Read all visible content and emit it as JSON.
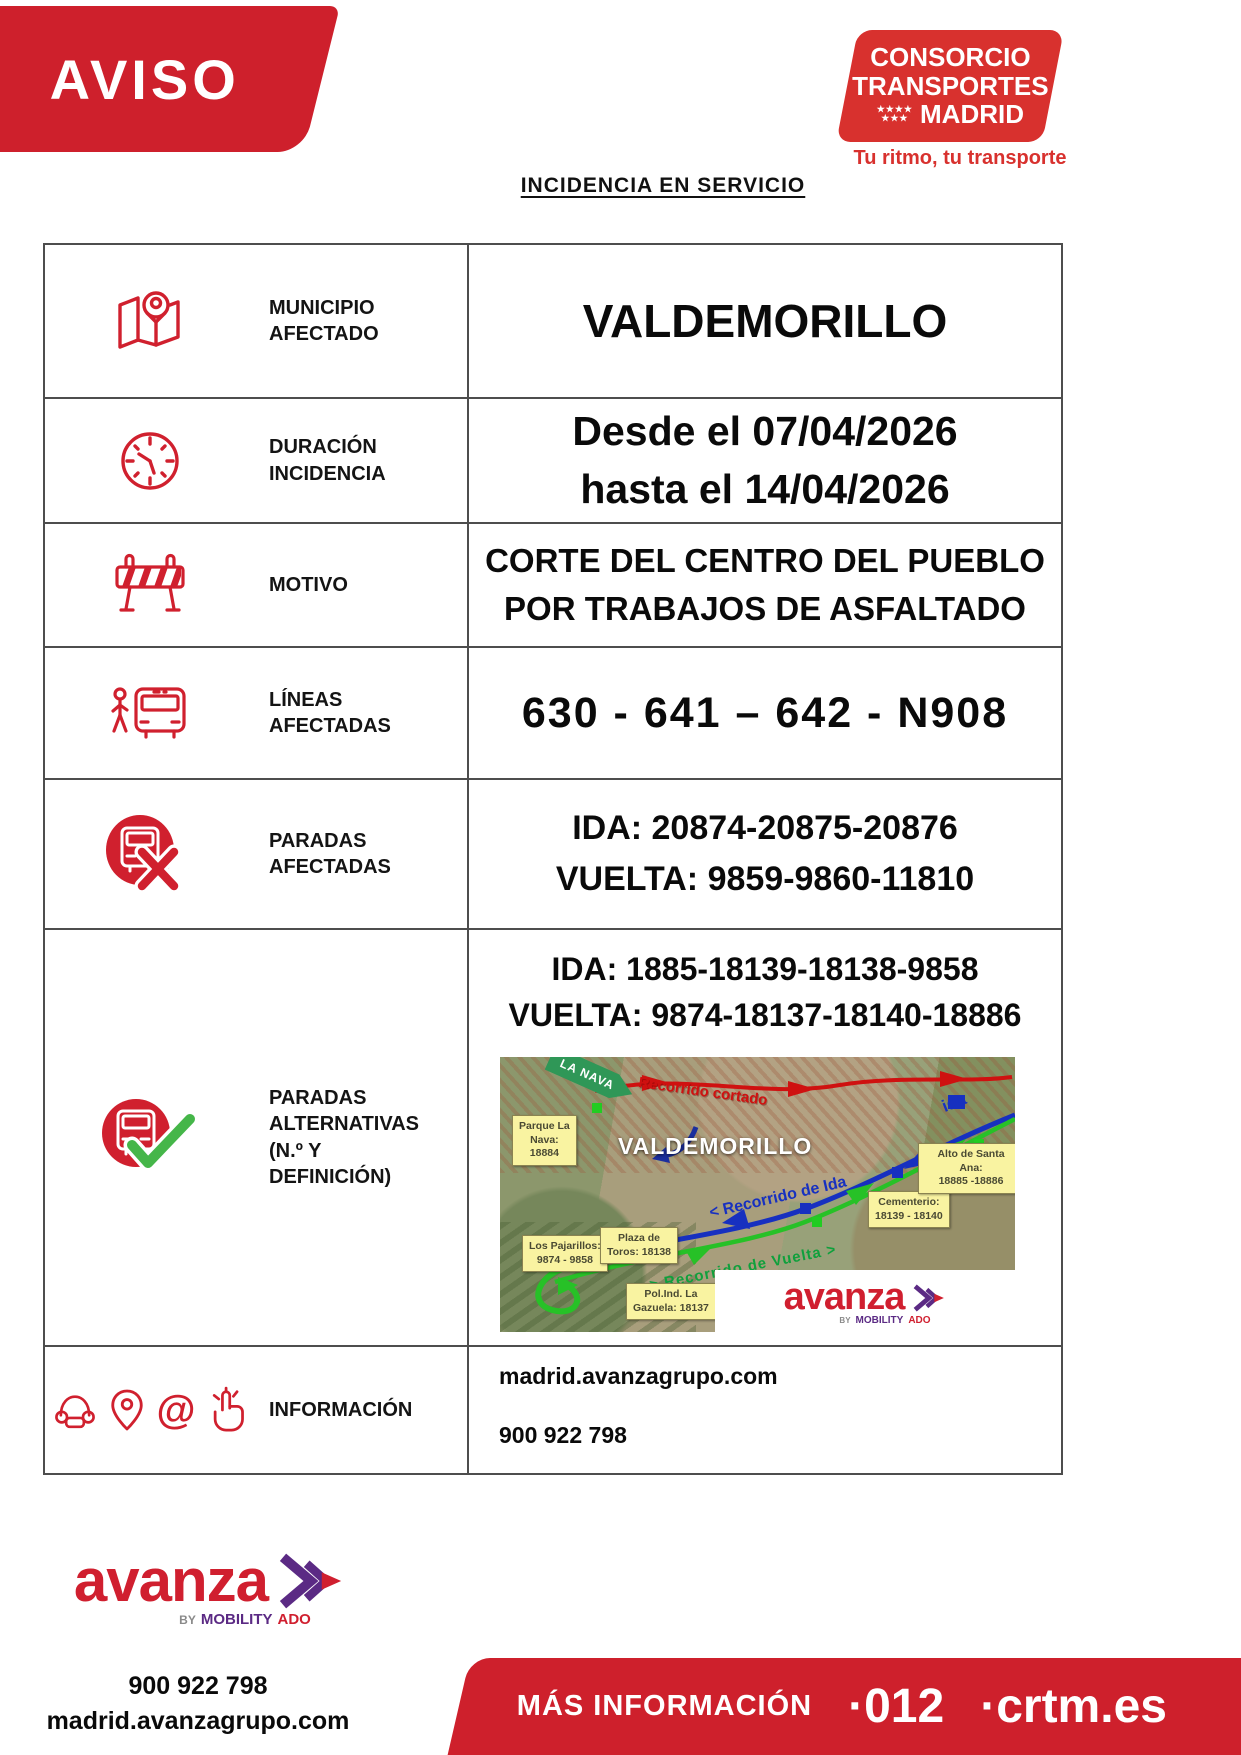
{
  "aviso_banner": {
    "text": "AVISO"
  },
  "ctm_logo": {
    "line1": "CONSORCIO",
    "line2": "TRANSPORTES",
    "line3": "MADRID",
    "stars_row1": "★★★★",
    "stars_row2": "★★★",
    "tagline": "Tu ritmo, tu transporte"
  },
  "page": {
    "heading": "INCIDENCIA EN SERVICIO"
  },
  "table": {
    "municipio": {
      "label": "MUNICIPIO\nAFECTADO",
      "value": "VALDEMORILLO"
    },
    "duracion": {
      "label": "DURACIÓN\nINCIDENCIA",
      "value": "Desde el 07/04/2026\nhasta el 14/04/2026"
    },
    "motivo": {
      "label": "MOTIVO",
      "value": "CORTE DEL CENTRO DEL PUEBLO\nPOR TRABAJOS DE ASFALTADO"
    },
    "lineas": {
      "label": "LÍNEAS\nAFECTADAS",
      "value": "630 - 641 – 642 - N908"
    },
    "paradas_afectadas": {
      "label": "PARADAS\nAFECTADAS",
      "value": "IDA: 20874-20875-20876\nVUELTA: 9859-9860-11810"
    },
    "paradas_alternativas": {
      "label": "PARADAS\nALTERNATIVAS\n(N.º Y\nDEFINICIÓN)",
      "value": "IDA: 1885-18139-18138-9858\nVUELTA: 9874-18137-18140-18886"
    },
    "informacion": {
      "label": "INFORMACIÓN",
      "value_web": "madrid.avanzagrupo.com",
      "value_phone": "900 922 798"
    }
  },
  "icons": {
    "at_symbol": "@"
  },
  "map": {
    "sign_la_nava": "LA NAVA",
    "town_label": "VALDEMORILLO",
    "route_cortado": "Recorrido cortado",
    "route_ida": "< Recorrido de Ida",
    "route_vuelta": "> Recorrido de Vuelta >",
    "ida_small": "ida",
    "callout_parque": "Parque La\nNava:\n18884",
    "callout_pajarillos": "Los Pajarillos:\n9874 - 9858",
    "callout_plaza": "Plaza de\nToros: 18138",
    "callout_polind": "Pol.Ind. La\nGazuela: 18137",
    "callout_cementerio": "Cementerio:\n18139 - 18140",
    "callout_santa_ana": "Alto de Santa Ana:\n18885 -18886"
  },
  "avanza": {
    "wordmark": "avanza",
    "by": "BY",
    "mobility": "MOBILITY",
    "ado": "ADO"
  },
  "footer": {
    "phone": "900 922 798",
    "web": "madrid.avanzagrupo.com",
    "mas_informacion": "MÁS INFORMACIÓN",
    "tel_012": "·012",
    "crtm": "·crtm.es"
  },
  "colors": {
    "brand_red": "#ce202c",
    "ctm_red": "#d8312e",
    "avanza_red": "#d01f2f",
    "avanza_purple": "#5b2a84",
    "route_red": "#cf1110",
    "route_blue": "#1730c0",
    "route_green": "#27c127",
    "callout_yellow": "#f9f3a1"
  }
}
